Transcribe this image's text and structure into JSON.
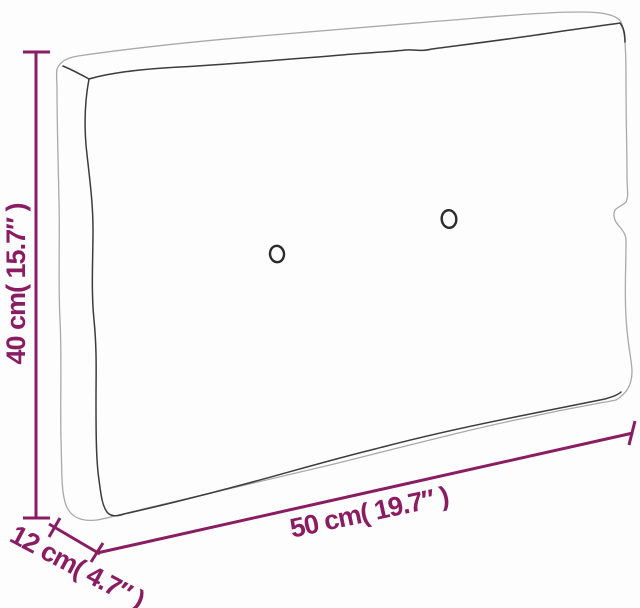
{
  "diagram": {
    "type": "product-dimension-diagram",
    "subject": "pallet-cushion-line-drawing",
    "tuft_buttons_count": 2,
    "dimensions": {
      "height": {
        "label": "40 cm( 15.7″ )",
        "value_cm": 40,
        "value_in": 15.7
      },
      "width": {
        "label": "50 cm( 19.7″ )",
        "value_cm": 50,
        "value_in": 19.7
      },
      "depth": {
        "label": "12 cm( 4.7″ )",
        "value_cm": 12,
        "value_in": 4.7
      }
    }
  },
  "colors": {
    "dimension": "#8a1c62",
    "outline_dark": "#3c3c3c",
    "outline_light": "#a9a9a9",
    "background": "#fdfdfd"
  }
}
